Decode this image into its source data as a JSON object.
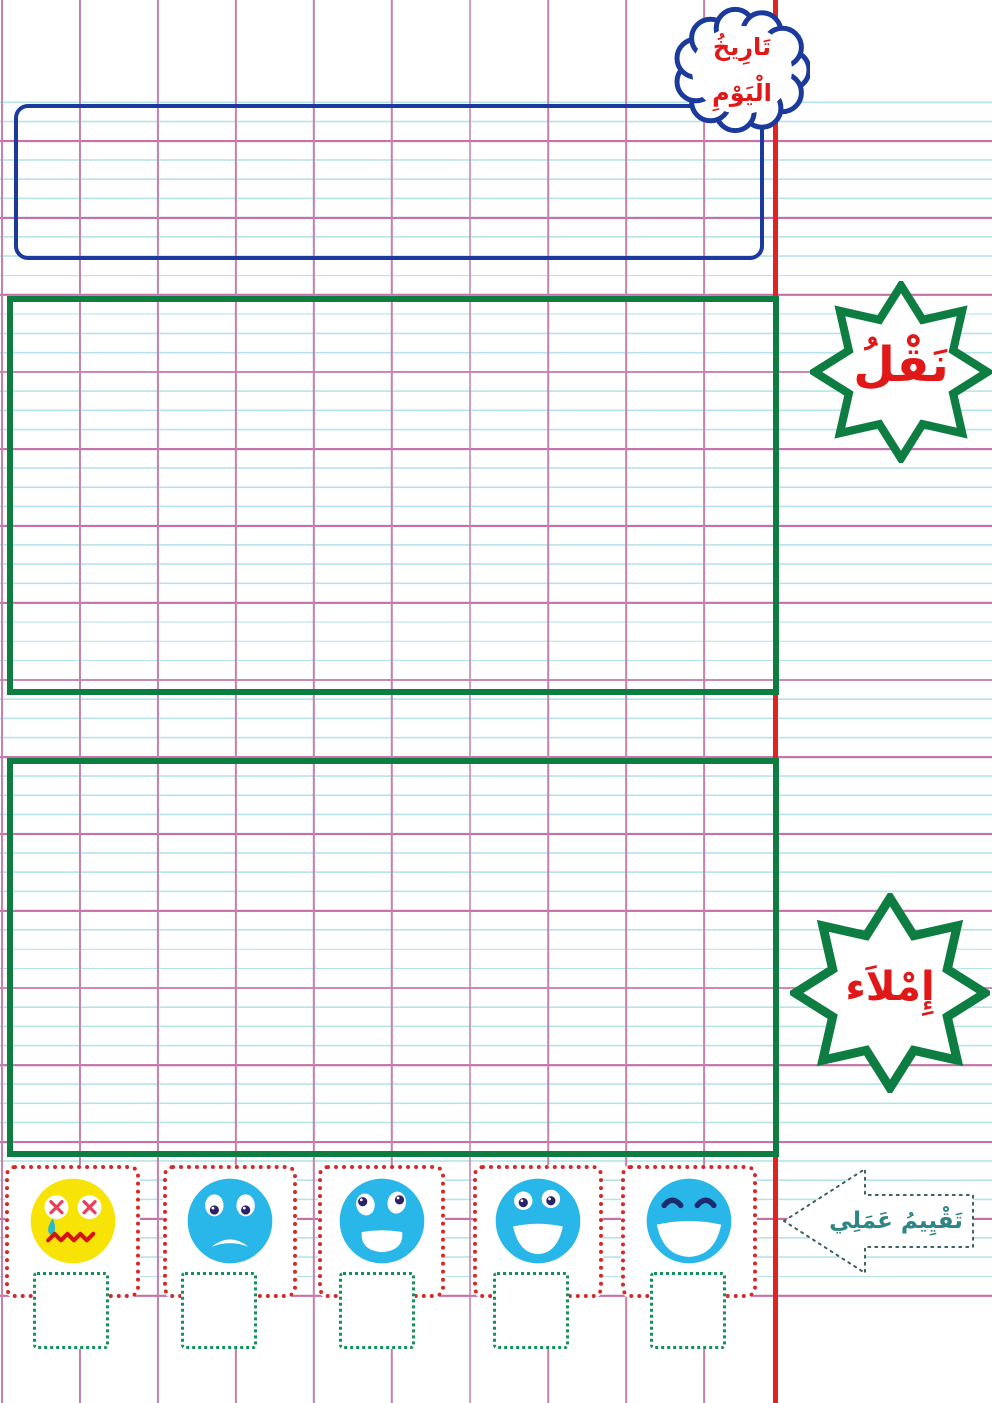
{
  "date_bubble": {
    "line1": "تَارِيخُ",
    "line2": "الْيَوْمِ"
  },
  "sections": {
    "naql": {
      "badge_label": "نَقْلُ"
    },
    "imlaa": {
      "badge_label": "إِمْلاَء"
    }
  },
  "evaluation": {
    "arrow_label": "تَقْيِيمُ عَمَلِي",
    "mood_icons": [
      "crying-face-icon",
      "sad-face-icon",
      "neutral-face-icon",
      "happy-face-icon",
      "laughing-face-icon"
    ]
  },
  "colors": {
    "rule_cyan": "#b5e3e8",
    "grid_pink": "#c482ac",
    "margin_red": "#e32222",
    "date_box_blue": "#1c3a9e",
    "section_green": "#0e7d42",
    "label_red": "#e01818",
    "face_blue": "#29b6e8",
    "face_yellow": "#f7e305",
    "mood_frame_red": "#d42a2a",
    "check_square_green": "#12915a",
    "arrow_teal": "#2e8585"
  }
}
